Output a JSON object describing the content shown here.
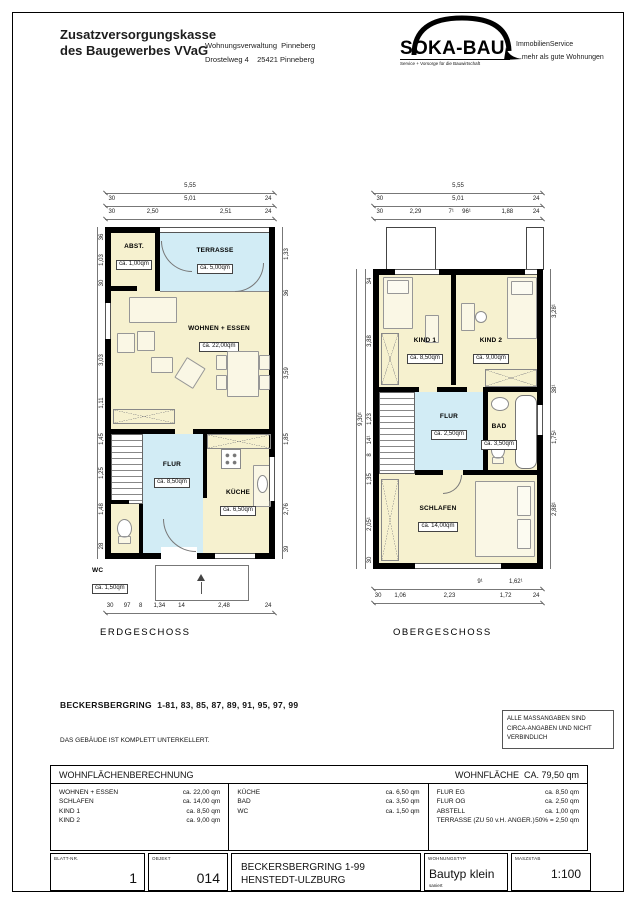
{
  "header": {
    "org": [
      "Zusatzversorgungskasse",
      "des Baugewerbes VVaG"
    ],
    "dept": [
      "Wohnungsverwaltung  Pinneberg",
      "Drostelweg 4    25421 Pinneberg"
    ],
    "logo": {
      "name": "SOKA-BAU",
      "tagline": "Service + Vorsorge für die Bauwirtschaft"
    },
    "service": [
      "ImmobilienService",
      "...mehr als gute Wohnungen"
    ]
  },
  "plans": {
    "eg": {
      "label": "ERDGESCHOSS",
      "rooms": {
        "abst": {
          "name": "ABST.",
          "area": "ca. 1,00qm"
        },
        "terrasse": {
          "name": "TERRASSE",
          "area": "ca. 5,00qm"
        },
        "wohnen": {
          "name": "WOHNEN + ESSEN",
          "area": "ca. 22,00qm"
        },
        "flur": {
          "name": "FLUR",
          "area": "ca. 8,50qm"
        },
        "kueche": {
          "name": "KÜCHE",
          "area": "ca. 6,50qm"
        },
        "wc": {
          "name": "WC",
          "area": "ca. 1,50qm"
        }
      },
      "dims": {
        "top1": [
          "5,55"
        ],
        "top2": [
          "30",
          "5,01",
          "24"
        ],
        "top3": [
          "30",
          "2,50",
          "2,51",
          "24"
        ],
        "bottom": [
          "30",
          "97",
          "8",
          "1,34",
          "14",
          "2,48",
          "24"
        ],
        "left": [
          "36",
          "1,03",
          "30",
          "3,03",
          "1,11",
          "1,45",
          "1,25",
          "1,48",
          "28"
        ],
        "right": [
          "1,33",
          "36",
          "3,59",
          "1,85",
          "2,76",
          "39"
        ]
      }
    },
    "og": {
      "label": "OBERGESCHOSS",
      "rooms": {
        "kind1": {
          "name": "KIND 1",
          "area": "ca. 8,50qm"
        },
        "kind2": {
          "name": "KIND 2",
          "area": "ca. 9,00qm"
        },
        "flur": {
          "name": "FLUR",
          "area": "ca. 2,50qm"
        },
        "bad": {
          "name": "BAD",
          "area": "ca. 3,50qm"
        },
        "schlafen": {
          "name": "SCHLAFEN",
          "area": "ca. 14,00qm"
        }
      },
      "dims": {
        "top1": [
          "5,55"
        ],
        "top2": [
          "30",
          "5,01",
          "24"
        ],
        "top3": [
          "30",
          "2,29",
          "7¹",
          "96¹",
          "1,88",
          "24"
        ],
        "bottom1": [
          "9¹",
          "1,62¹"
        ],
        "bottom2": [
          "30",
          "1,06",
          "2,23",
          "1,72",
          "24"
        ],
        "left": [
          "34",
          "3,88",
          "1,23",
          "14¹",
          "8",
          "1,35",
          "2,05¹",
          "30"
        ],
        "left_total": [
          "9,30¹"
        ],
        "right": [
          "3,28¹",
          "38¹",
          "1,75¹",
          "2,88¹"
        ]
      }
    }
  },
  "notes": {
    "address": "BECKERSBERGRING  1-81, 83, 85, 87, 89, 91, 95, 97, 99",
    "basement": "DAS GEBÄUDE IST KOMPLETT UNTERKELLERT.",
    "disclaimer": [
      "ALLE MASSANGABEN SIND",
      "CIRCA-ANGABEN UND NICHT",
      "VERBINDLICH"
    ]
  },
  "area_table": {
    "title": "WOHNFLÄCHENBERECHNUNG",
    "total": "WOHNFLÄCHE  CA. 79,50 qm",
    "col1": [
      [
        "WOHNEN + ESSEN",
        "ca. 22,00 qm"
      ],
      [
        "SCHLAFEN",
        "ca. 14,00 qm"
      ],
      [
        "KIND 1",
        "ca. 8,50 qm"
      ],
      [
        "KIND 2",
        "ca. 9,00 qm"
      ]
    ],
    "col2": [
      [
        "KÜCHE",
        "ca. 6,50 qm"
      ],
      [
        "BAD",
        "ca. 3,50 qm"
      ],
      [
        "WC",
        "ca. 1,50 qm"
      ]
    ],
    "col3": [
      [
        "FLUR EG",
        "ca. 8,50 qm"
      ],
      [
        "FLUR OG",
        "ca. 2,50 qm"
      ],
      [
        "ABSTELL",
        "ca. 1,00 qm"
      ],
      [
        "TERRASSE (ZU 50 v.H. ANGER.)",
        "50% = 2,50 qm"
      ]
    ]
  },
  "title_block": {
    "blatt_label": "BLATT-NR.",
    "blatt_value": "1",
    "objekt_label": "OBJEKT",
    "objekt_value": "014",
    "project": [
      "BECKERSBERGRING 1-99",
      "HENSTEDT-ULZBURG"
    ],
    "typ_label": "WOHNUNGSTYP",
    "typ_value": "Bautyp klein",
    "typ_sub": "saniert",
    "masstab_label": "MASZSTAB",
    "masstab_value": "1:100"
  },
  "colors": {
    "room_fill": "#f6f1cf",
    "wet_fill": "#d2ecf5",
    "wall": "#000000"
  }
}
